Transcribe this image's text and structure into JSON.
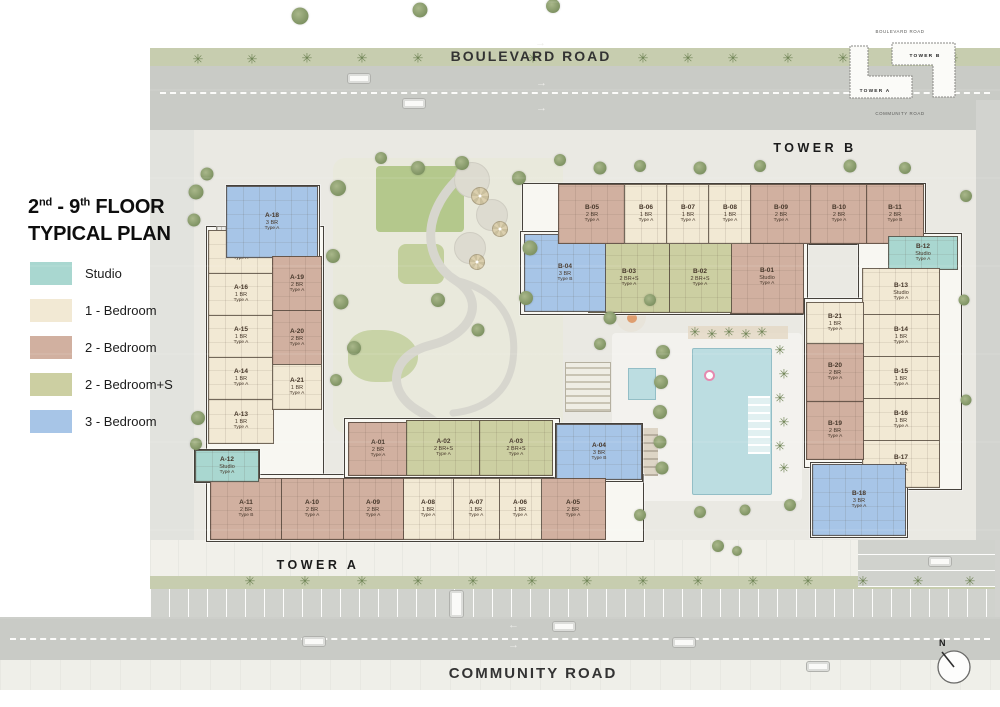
{
  "title": {
    "n1": "2",
    "s1": "nd",
    "n2": " - 9",
    "s2": "th",
    "rest": " FLOOR",
    "line2": "TYPICAL PLAN"
  },
  "palette": {
    "studio": "#a9d7d0",
    "br1": "#f2e9d4",
    "br2": "#d1b0a0",
    "br2s": "#cccfa2",
    "br3": "#a7c5e7"
  },
  "legend": [
    {
      "key": "studio",
      "label": "Studio"
    },
    {
      "key": "br1",
      "label": "1 - Bedroom"
    },
    {
      "key": "br2",
      "label": "2 - Bedroom"
    },
    {
      "key": "br2s",
      "label": "2 - Bedroom+S"
    },
    {
      "key": "br3",
      "label": "3 - Bedroom"
    }
  ],
  "labels": {
    "boulevard_road": "BOULEVARD ROAD",
    "community_road": "COMMUNITY ROAD",
    "tower_a": "TOWER A",
    "tower_b": "TOWER B",
    "compass_n": "N"
  },
  "minimap": {
    "top": "BOULEVARD ROAD",
    "bottom": "COMMUNITY ROAD",
    "tower_a": "TOWER A",
    "tower_b": "TOWER B"
  },
  "units": [
    {
      "id": "A-01",
      "type": "2 BR",
      "variant": "Type A",
      "cat": "br2",
      "x": 348,
      "y": 422,
      "w": 58,
      "h": 52
    },
    {
      "id": "A-02",
      "type": "2 BR+S",
      "variant": "Type A",
      "cat": "br2s",
      "x": 406,
      "y": 420,
      "w": 73,
      "h": 54
    },
    {
      "id": "A-03",
      "type": "2 BR+S",
      "variant": "Type A",
      "cat": "br2s",
      "x": 479,
      "y": 420,
      "w": 72,
      "h": 54
    },
    {
      "id": "A-04",
      "type": "3 BR",
      "variant": "Type B",
      "cat": "br3",
      "x": 556,
      "y": 424,
      "w": 84,
      "h": 54
    },
    {
      "id": "A-05",
      "type": "2 BR",
      "variant": "Type A",
      "cat": "br2",
      "x": 540,
      "y": 478,
      "w": 64,
      "h": 60
    },
    {
      "id": "A-06",
      "type": "1 BR",
      "variant": "Type A",
      "cat": "br1",
      "x": 498,
      "y": 478,
      "w": 42,
      "h": 60
    },
    {
      "id": "A-07",
      "type": "1 BR",
      "variant": "Type A",
      "cat": "br1",
      "x": 452,
      "y": 478,
      "w": 46,
      "h": 60
    },
    {
      "id": "A-08",
      "type": "1 BR",
      "variant": "Type A",
      "cat": "br1",
      "x": 402,
      "y": 478,
      "w": 50,
      "h": 60
    },
    {
      "id": "A-09",
      "type": "2 BR",
      "variant": "Type A",
      "cat": "br2",
      "x": 342,
      "y": 478,
      "w": 60,
      "h": 60
    },
    {
      "id": "A-10",
      "type": "2 BR",
      "variant": "Type A",
      "cat": "br2",
      "x": 280,
      "y": 478,
      "w": 62,
      "h": 60
    },
    {
      "id": "A-11",
      "type": "2 BR",
      "variant": "Type B",
      "cat": "br2",
      "x": 210,
      "y": 478,
      "w": 70,
      "h": 60
    },
    {
      "id": "A-12",
      "type": "Studio",
      "variant": "Type A",
      "cat": "studio",
      "x": 195,
      "y": 450,
      "w": 62,
      "h": 30
    },
    {
      "id": "A-13",
      "type": "1 BR",
      "variant": "Type A",
      "cat": "br1",
      "x": 208,
      "y": 398,
      "w": 64,
      "h": 44
    },
    {
      "id": "A-14",
      "type": "1 BR",
      "variant": "Type A",
      "cat": "br1",
      "x": 208,
      "y": 356,
      "w": 64,
      "h": 42
    },
    {
      "id": "A-15",
      "type": "1 BR",
      "variant": "Type A",
      "cat": "br1",
      "x": 208,
      "y": 314,
      "w": 64,
      "h": 42
    },
    {
      "id": "A-16",
      "type": "1 BR",
      "variant": "Type A",
      "cat": "br1",
      "x": 208,
      "y": 272,
      "w": 64,
      "h": 42
    },
    {
      "id": "A-17",
      "type": "1 BR",
      "variant": "Type A",
      "cat": "br1",
      "x": 208,
      "y": 230,
      "w": 64,
      "h": 42
    },
    {
      "id": "A-18",
      "type": "3 BR",
      "variant": "Type A",
      "cat": "br3",
      "x": 226,
      "y": 186,
      "w": 90,
      "h": 70
    },
    {
      "id": "A-19",
      "type": "2 BR",
      "variant": "Type A",
      "cat": "br2",
      "x": 272,
      "y": 256,
      "w": 48,
      "h": 54
    },
    {
      "id": "A-20",
      "type": "2 BR",
      "variant": "Type A",
      "cat": "br2",
      "x": 272,
      "y": 310,
      "w": 48,
      "h": 54
    },
    {
      "id": "A-21",
      "type": "1 BR",
      "variant": "Type A",
      "cat": "br1",
      "x": 272,
      "y": 364,
      "w": 48,
      "h": 44
    },
    {
      "id": "B-01",
      "type": "Studio",
      "variant": "Type A",
      "cat": "br2",
      "x": 730,
      "y": 240,
      "w": 72,
      "h": 72
    },
    {
      "id": "B-02",
      "type": "2 BR+S",
      "variant": "Type A",
      "cat": "br2s",
      "x": 668,
      "y": 243,
      "w": 62,
      "h": 68
    },
    {
      "id": "B-03",
      "type": "2 BR+S",
      "variant": "Type A",
      "cat": "br2s",
      "x": 588,
      "y": 243,
      "w": 80,
      "h": 68
    },
    {
      "id": "B-04",
      "type": "3 BR",
      "variant": "Type B",
      "cat": "br3",
      "x": 524,
      "y": 234,
      "w": 80,
      "h": 76
    },
    {
      "id": "B-05",
      "type": "2 BR",
      "variant": "Type A",
      "cat": "br2",
      "x": 558,
      "y": 184,
      "w": 66,
      "h": 58
    },
    {
      "id": "B-06",
      "type": "1 BR",
      "variant": "Type A",
      "cat": "br1",
      "x": 624,
      "y": 184,
      "w": 42,
      "h": 58
    },
    {
      "id": "B-07",
      "type": "1 BR",
      "variant": "Type A",
      "cat": "br1",
      "x": 666,
      "y": 184,
      "w": 42,
      "h": 58
    },
    {
      "id": "B-08",
      "type": "1 BR",
      "variant": "Type A",
      "cat": "br1",
      "x": 708,
      "y": 184,
      "w": 42,
      "h": 58
    },
    {
      "id": "B-09",
      "type": "2 BR",
      "variant": "Type A",
      "cat": "br2",
      "x": 750,
      "y": 184,
      "w": 60,
      "h": 58
    },
    {
      "id": "B-10",
      "type": "2 BR",
      "variant": "Type A",
      "cat": "br2",
      "x": 810,
      "y": 184,
      "w": 56,
      "h": 58
    },
    {
      "id": "B-11",
      "type": "2 BR",
      "variant": "Type B",
      "cat": "br2",
      "x": 866,
      "y": 184,
      "w": 56,
      "h": 58
    },
    {
      "id": "B-12",
      "type": "Studio",
      "variant": "Type A",
      "cat": "studio",
      "x": 888,
      "y": 236,
      "w": 68,
      "h": 32
    },
    {
      "id": "B-13",
      "type": "Studio",
      "variant": "Type A",
      "cat": "br1",
      "x": 862,
      "y": 268,
      "w": 76,
      "h": 46
    },
    {
      "id": "B-14",
      "type": "1 BR",
      "variant": "Type A",
      "cat": "br1",
      "x": 862,
      "y": 314,
      "w": 76,
      "h": 42
    },
    {
      "id": "B-15",
      "type": "1 BR",
      "variant": "Type A",
      "cat": "br1",
      "x": 862,
      "y": 356,
      "w": 76,
      "h": 42
    },
    {
      "id": "B-16",
      "type": "1 BR",
      "variant": "Type A",
      "cat": "br1",
      "x": 862,
      "y": 398,
      "w": 76,
      "h": 42
    },
    {
      "id": "B-17",
      "type": "1 BR",
      "variant": "Type A",
      "cat": "br1",
      "x": 862,
      "y": 440,
      "w": 76,
      "h": 46
    },
    {
      "id": "B-18",
      "type": "3 BR",
      "variant": "Type A",
      "cat": "br3",
      "x": 812,
      "y": 464,
      "w": 92,
      "h": 70
    },
    {
      "id": "B-19",
      "type": "2 BR",
      "variant": "Type A",
      "cat": "br2",
      "x": 806,
      "y": 400,
      "w": 56,
      "h": 58
    },
    {
      "id": "B-20",
      "type": "2 BR",
      "variant": "Type A",
      "cat": "br2",
      "x": 806,
      "y": 342,
      "w": 56,
      "h": 58
    },
    {
      "id": "B-21",
      "type": "1 BR",
      "variant": "Type A",
      "cat": "br1",
      "x": 806,
      "y": 302,
      "w": 56,
      "h": 40
    }
  ],
  "wings": [
    [
      206,
      226,
      116,
      254
    ],
    [
      226,
      185,
      92,
      72
    ],
    [
      206,
      474,
      436,
      66
    ],
    [
      344,
      418,
      214,
      58
    ],
    [
      555,
      423,
      86,
      57
    ],
    [
      194,
      449,
      64,
      32
    ],
    [
      522,
      183,
      402,
      60
    ],
    [
      520,
      231,
      286,
      82
    ],
    [
      858,
      233,
      102,
      255
    ],
    [
      804,
      298,
      58,
      168
    ],
    [
      810,
      462,
      96,
      74
    ]
  ],
  "cores": [
    [
      216,
      226,
      36,
      13
    ],
    [
      455,
      444,
      38,
      26
    ],
    [
      643,
      252,
      28,
      34
    ],
    [
      884,
      468,
      38,
      18
    ]
  ],
  "landscape": {
    "palm_glyph": "✳",
    "trees": [
      [
        300,
        16,
        17
      ],
      [
        420,
        10,
        15
      ],
      [
        553,
        6,
        14
      ],
      [
        196,
        192,
        15
      ],
      [
        207,
        174,
        13
      ],
      [
        194,
        220,
        13
      ],
      [
        198,
        418,
        14
      ],
      [
        196,
        444,
        12
      ],
      [
        338,
        188,
        16
      ],
      [
        333,
        256,
        14
      ],
      [
        341,
        302,
        15
      ],
      [
        354,
        348,
        14
      ],
      [
        336,
        380,
        12
      ],
      [
        418,
        168,
        14
      ],
      [
        462,
        163,
        14
      ],
      [
        519,
        178,
        14
      ],
      [
        381,
        158,
        12
      ],
      [
        530,
        248,
        15
      ],
      [
        526,
        298,
        14
      ],
      [
        478,
        330,
        13
      ],
      [
        438,
        300,
        14
      ],
      [
        560,
        160,
        12
      ],
      [
        600,
        168,
        13
      ],
      [
        640,
        166,
        12
      ],
      [
        700,
        168,
        13
      ],
      [
        760,
        166,
        12
      ],
      [
        850,
        166,
        13
      ],
      [
        905,
        168,
        12
      ],
      [
        610,
        318,
        13
      ],
      [
        600,
        344,
        12
      ],
      [
        650,
        300,
        12
      ],
      [
        663,
        352,
        14
      ],
      [
        661,
        382,
        14
      ],
      [
        660,
        412,
        14
      ],
      [
        660,
        442,
        13
      ],
      [
        662,
        468,
        13
      ],
      [
        790,
        505,
        12
      ],
      [
        640,
        515,
        12
      ],
      [
        700,
        512,
        12
      ],
      [
        745,
        510,
        11
      ],
      [
        966,
        196,
        12
      ],
      [
        964,
        300,
        11
      ],
      [
        966,
        400,
        11
      ],
      [
        718,
        546,
        12
      ],
      [
        737,
        551,
        10
      ]
    ],
    "palms": [
      [
        198,
        59
      ],
      [
        252,
        59
      ],
      [
        307,
        58
      ],
      [
        362,
        58
      ],
      [
        418,
        58
      ],
      [
        533,
        58
      ],
      [
        643,
        58
      ],
      [
        688,
        58
      ],
      [
        733,
        58
      ],
      [
        788,
        58
      ],
      [
        843,
        58
      ],
      [
        898,
        58
      ],
      [
        953,
        58
      ],
      [
        250,
        581
      ],
      [
        305,
        581
      ],
      [
        362,
        581
      ],
      [
        418,
        581
      ],
      [
        473,
        581
      ],
      [
        532,
        581
      ],
      [
        587,
        581
      ],
      [
        643,
        581
      ],
      [
        698,
        581
      ],
      [
        753,
        581
      ],
      [
        808,
        581
      ],
      [
        863,
        581
      ],
      [
        918,
        581
      ],
      [
        970,
        581
      ],
      [
        695,
        332
      ],
      [
        712,
        334
      ],
      [
        729,
        332
      ],
      [
        746,
        334
      ],
      [
        762,
        332
      ],
      [
        780,
        350
      ],
      [
        784,
        374
      ],
      [
        780,
        398
      ],
      [
        784,
        422
      ],
      [
        780,
        446
      ],
      [
        784,
        468
      ]
    ],
    "park_plazas": [
      [
        472,
        180,
        34
      ],
      [
        492,
        215,
        30
      ],
      [
        470,
        248,
        30
      ]
    ],
    "park_umbrellas": [
      [
        480,
        196,
        18
      ],
      [
        500,
        229,
        16
      ],
      [
        477,
        262,
        16
      ]
    ]
  },
  "vehicles": [
    [
      347,
      73,
      "h"
    ],
    [
      402,
      98,
      "h"
    ],
    [
      302,
      636,
      "h"
    ],
    [
      552,
      621,
      "h"
    ],
    [
      672,
      637,
      "h"
    ],
    [
      806,
      661,
      "h"
    ],
    [
      928,
      556,
      "h"
    ],
    [
      449,
      590,
      "v"
    ]
  ],
  "arrows": [
    [
      535,
      38,
      "r"
    ],
    [
      536,
      78,
      "r"
    ],
    [
      536,
      103,
      "r"
    ],
    [
      508,
      620,
      "l"
    ],
    [
      508,
      640,
      "r"
    ]
  ],
  "glyphs": {
    "r": "→",
    "l": "←"
  }
}
